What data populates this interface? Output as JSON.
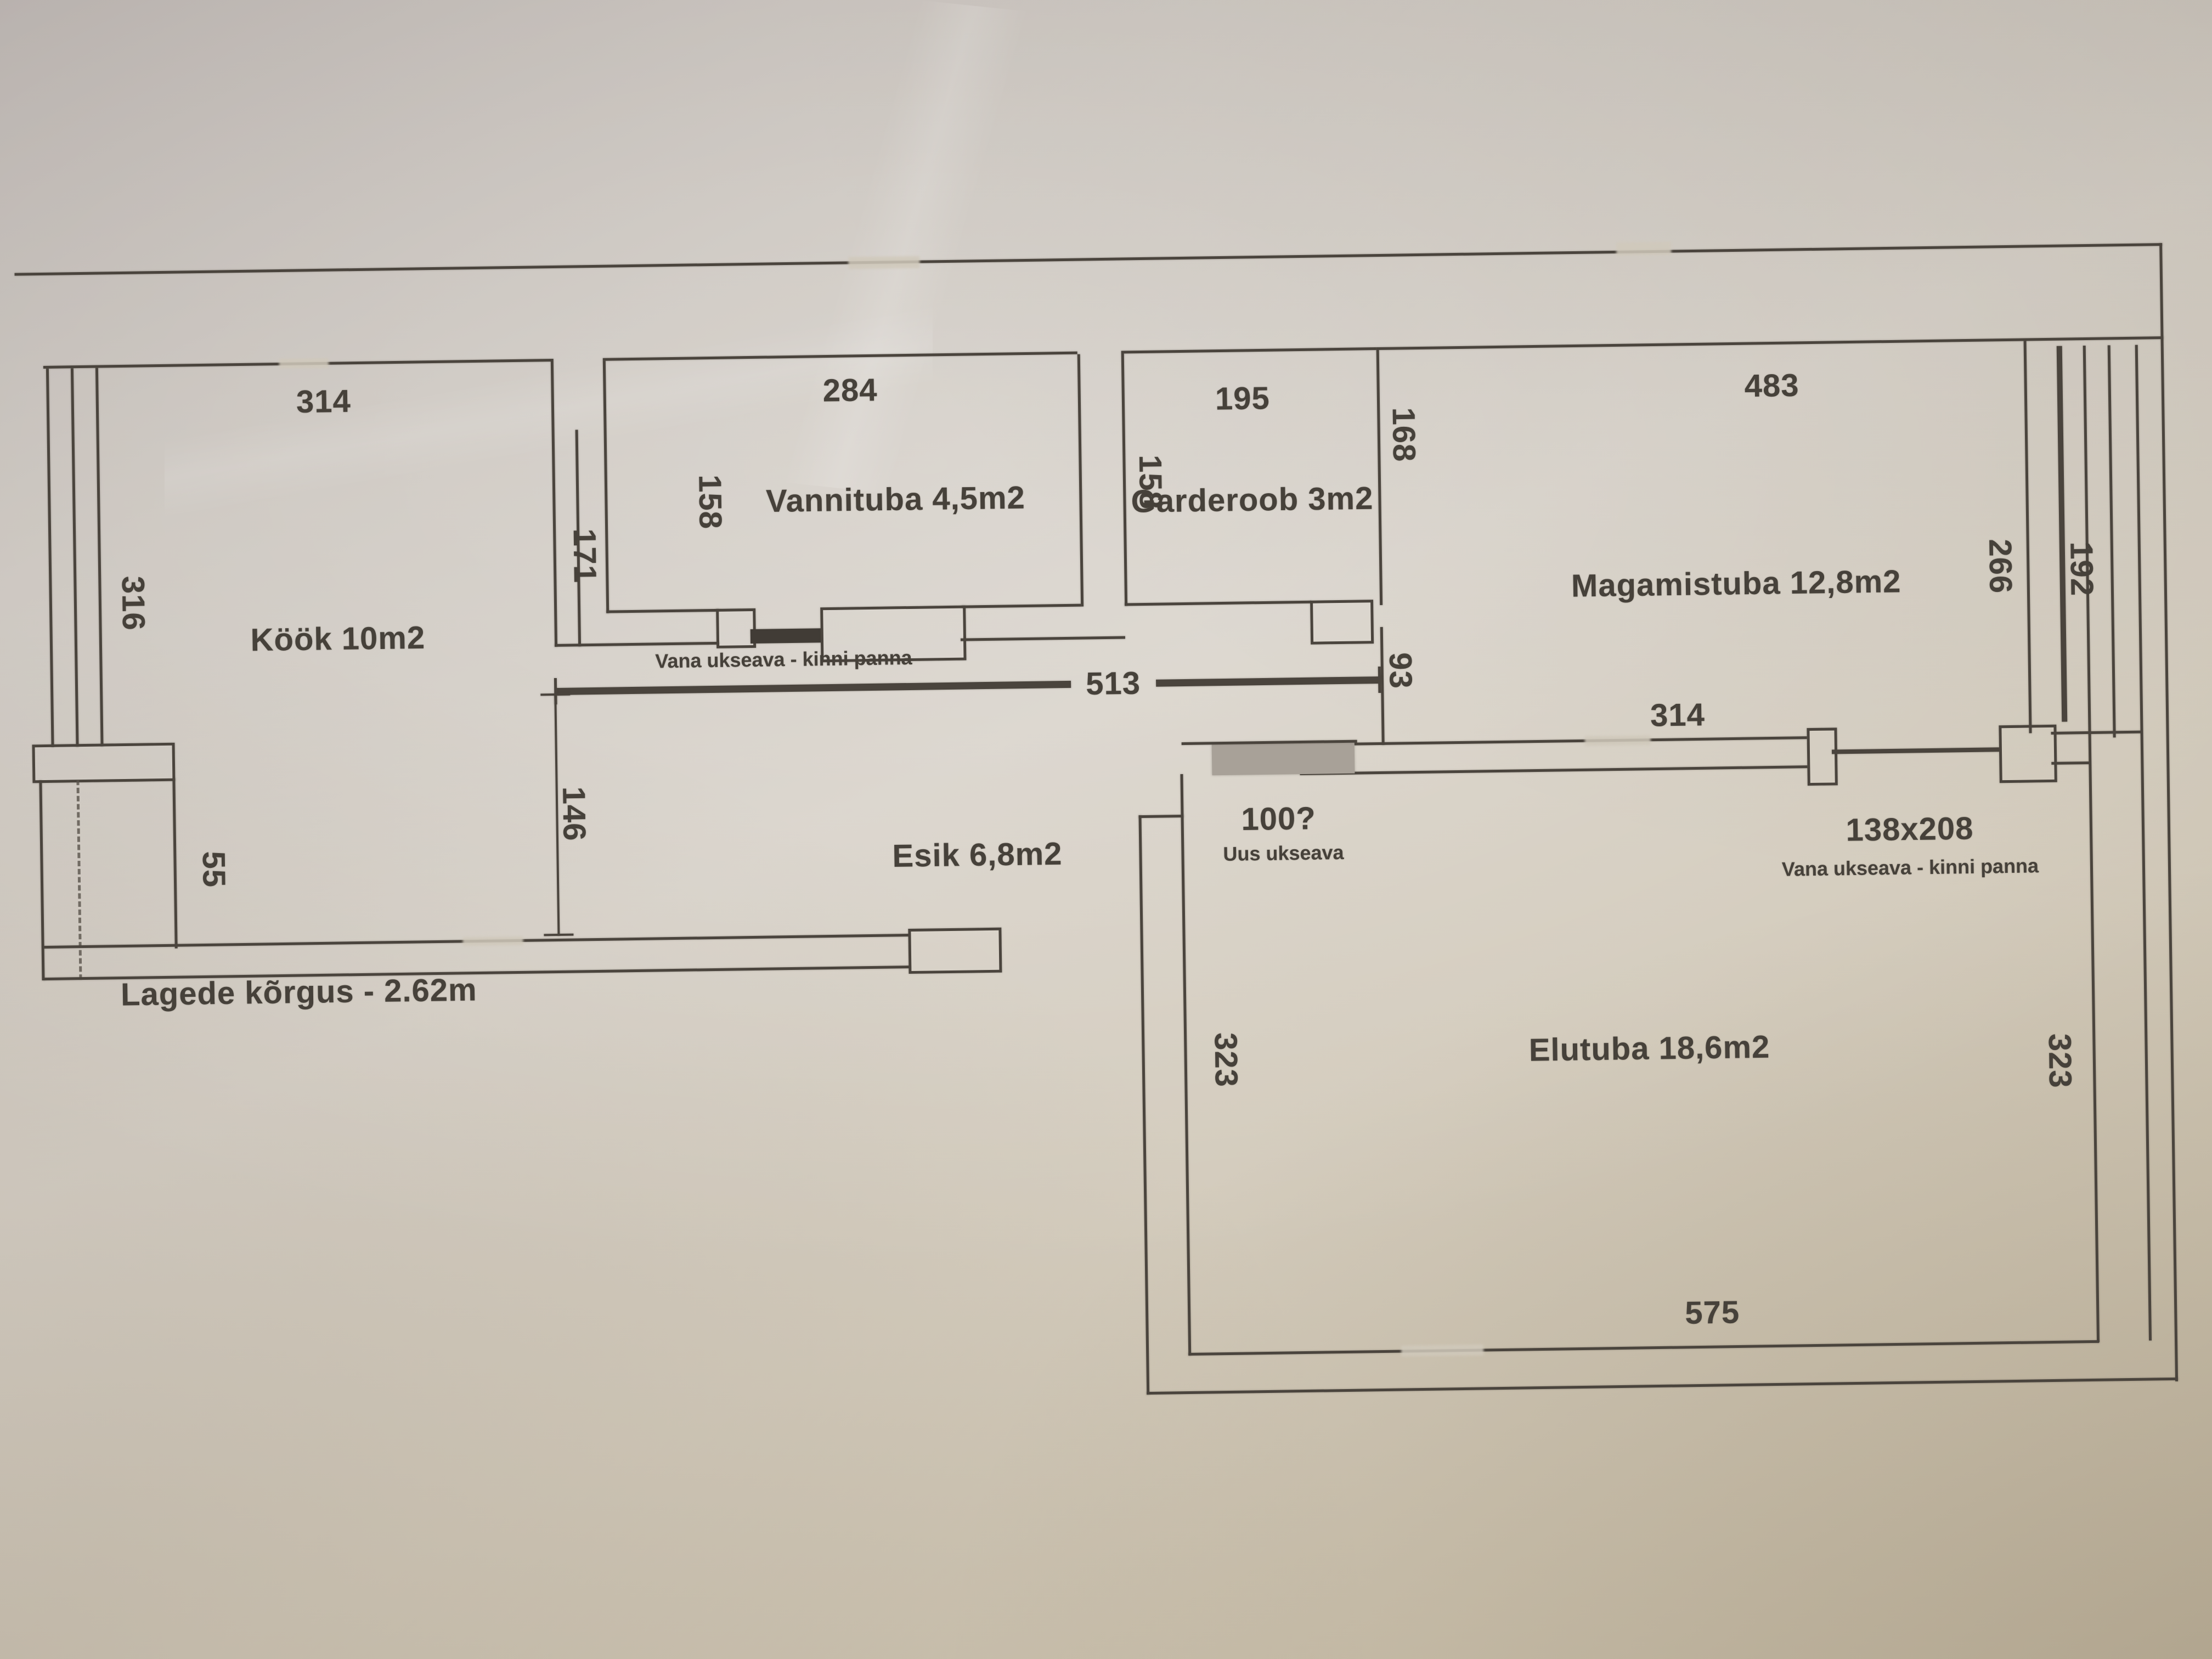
{
  "floorplan": {
    "rooms": {
      "kook": "Köök 10m2",
      "vann": "Vannituba 4,5m2",
      "gard": "Garderoob 3m2",
      "magam": "Magamistuba 12,8m2",
      "esik": "Esik 6,8m2",
      "elu": "Elutuba 18,6m2"
    },
    "dims": {
      "kook_top": "314",
      "kook_left": "316",
      "kook_right": "171",
      "kook_step": "55",
      "vann_top": "284",
      "vann_left": "158",
      "gard_top": "195",
      "gard_left": "158",
      "magam_top": "483",
      "magam_left_upper": "168",
      "magam_left_lower": "93",
      "magam_bottom": "314",
      "magam_right": "266",
      "magam_window": "192",
      "esik_width": "513",
      "esik_depth": "146",
      "elu_left": "323",
      "elu_right": "323",
      "elu_bottom": "575",
      "new_door": "100?",
      "old_door_size": "138x208"
    },
    "notes": {
      "close_old_door_1": "Vana ukseava - kinni panna",
      "close_old_door_2": "Vana ukseava - kinni panna",
      "new_door": "Uus ukseava",
      "ceiling": "Lagede kõrgus - 2.62m"
    },
    "colors": {
      "paper": "#d2cabb",
      "ink": "#4a443d",
      "new_door_fill": "#a8a198"
    }
  }
}
